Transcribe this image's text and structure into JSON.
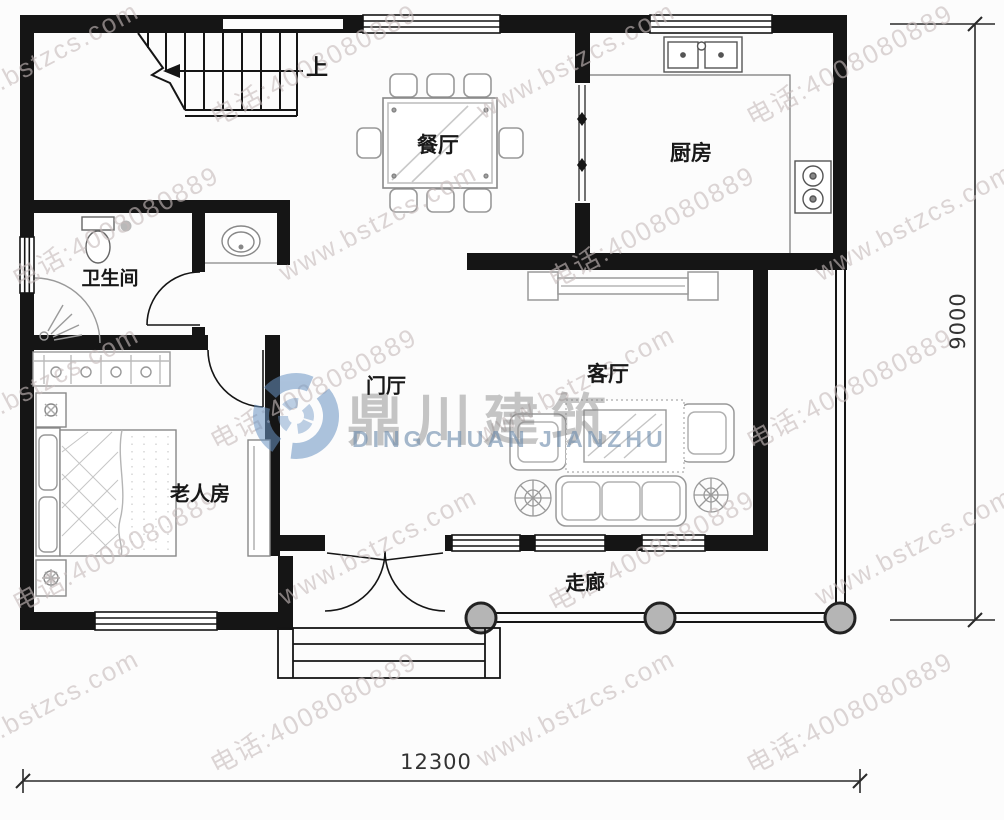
{
  "rooms": {
    "dining": {
      "label": "餐厅"
    },
    "kitchen": {
      "label": "厨房"
    },
    "bathroom": {
      "label": "卫生间"
    },
    "foyer": {
      "label": "门厅"
    },
    "living": {
      "label": "客厅"
    },
    "bedroom": {
      "label": "老人房"
    },
    "corridor": {
      "label": "走廊"
    }
  },
  "stairs": {
    "direction_label": "上"
  },
  "dimensions": {
    "bottom_width": "12300",
    "right_height": "9000"
  },
  "watermark": {
    "site_url": "www.bstzcs.com",
    "phone": "电话:4008080889"
  },
  "logo": {
    "title": "鼎川建筑",
    "subtitle": "DINGCHUAN JIANZHU"
  },
  "colors": {
    "wall": "#151515",
    "furniture_line": "#999999",
    "fixture_line": "#666666",
    "column_fill": "#b5b5b5",
    "watermark_text": "#c7bbbb",
    "logo_blue": "#6a93c2",
    "dimension_line": "#2a2a2a"
  }
}
